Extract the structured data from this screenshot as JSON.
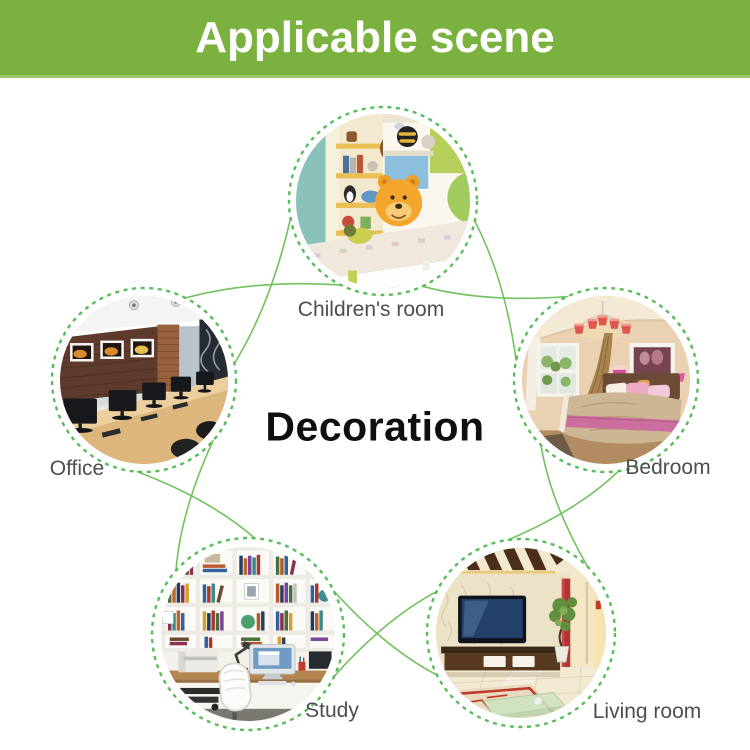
{
  "banner": {
    "title": "Applicable scene"
  },
  "center": {
    "title": "Decoration"
  },
  "scenes": {
    "children": {
      "label": "Children's room"
    },
    "bedroom": {
      "label": "Bedroom"
    },
    "living": {
      "label": "Living room"
    },
    "study": {
      "label": "Study"
    },
    "office": {
      "label": "Office"
    }
  },
  "colors": {
    "banner_green": "#7bb23f",
    "line_green": "#72c25e",
    "ring_green": "#57bd5b",
    "label_gray": "#4e4e4e",
    "title_black": "#0f0f0f"
  }
}
